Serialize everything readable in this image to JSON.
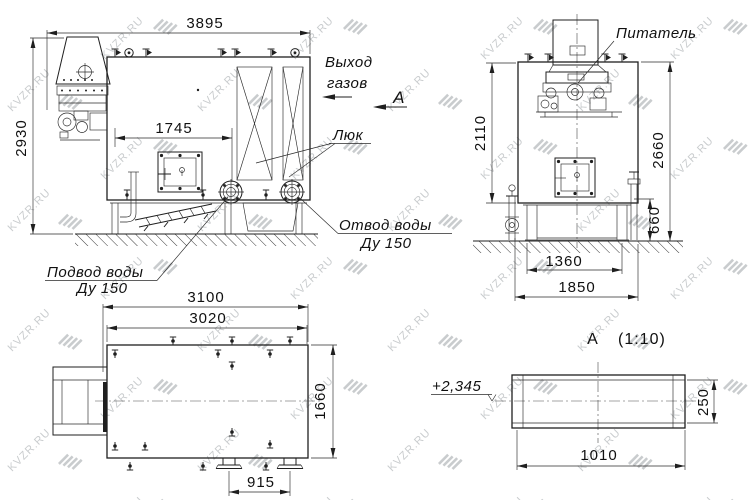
{
  "colors": {
    "background": "#ffffff",
    "line": "#1f1f1f",
    "watermark": "#c9ccce"
  },
  "watermark": {
    "text": "KVZR.RU"
  },
  "side_view": {
    "dim_width": "3895",
    "dim_height": "2930",
    "dim_burner_to_outlet": "1745",
    "label_gas_exit_line1": "Выход",
    "label_gas_exit_line2": "газов",
    "label_section_arrow": "А",
    "label_hatch": "Люк",
    "label_water_outlet_line1": "Отвод воды",
    "label_water_outlet_line2": "Ду 150",
    "label_water_inlet_line1": "Подвод воды",
    "label_water_inlet_line2": "Ду 150"
  },
  "front_view": {
    "label_feeder": "Питатель",
    "dim_hopper_height": "2110",
    "dim_total_height": "2660",
    "dim_base_height": "660",
    "dim_base_width": "1360",
    "dim_overall_width": "1850"
  },
  "top_view": {
    "dim_overall_length": "3100",
    "dim_body_length": "3020",
    "dim_body_width": "1660",
    "dim_flange_spacing": "915"
  },
  "section_view": {
    "title_letter": "А",
    "title_scale": "(1:10)",
    "level_mark": "+2,345",
    "dim_height": "250",
    "dim_width": "1010"
  }
}
